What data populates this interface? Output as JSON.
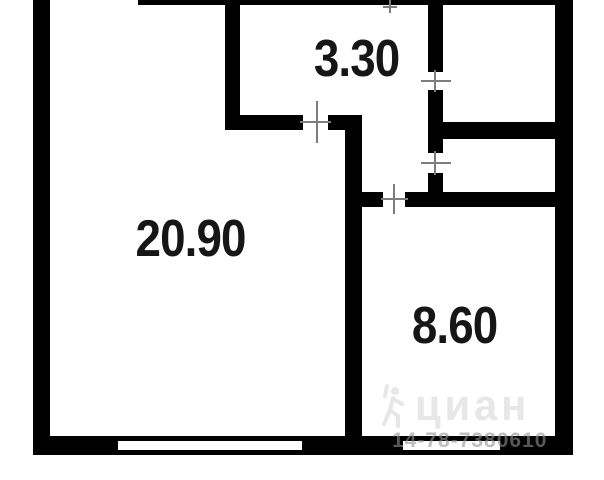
{
  "floorplan": {
    "rooms": [
      {
        "id": "living-room",
        "area": "20.90"
      },
      {
        "id": "hallway",
        "area": "3.30"
      },
      {
        "id": "kitchen",
        "area": "8.60"
      }
    ],
    "watermark": {
      "brand": "циан",
      "id": "14-78-7380610"
    },
    "colors": {
      "wall": "#000000",
      "background": "#ffffff",
      "label": "#161616",
      "door_tick": "#7d7d7d",
      "watermark_logo": "#e7e7e7",
      "watermark_id": "#919191"
    }
  }
}
